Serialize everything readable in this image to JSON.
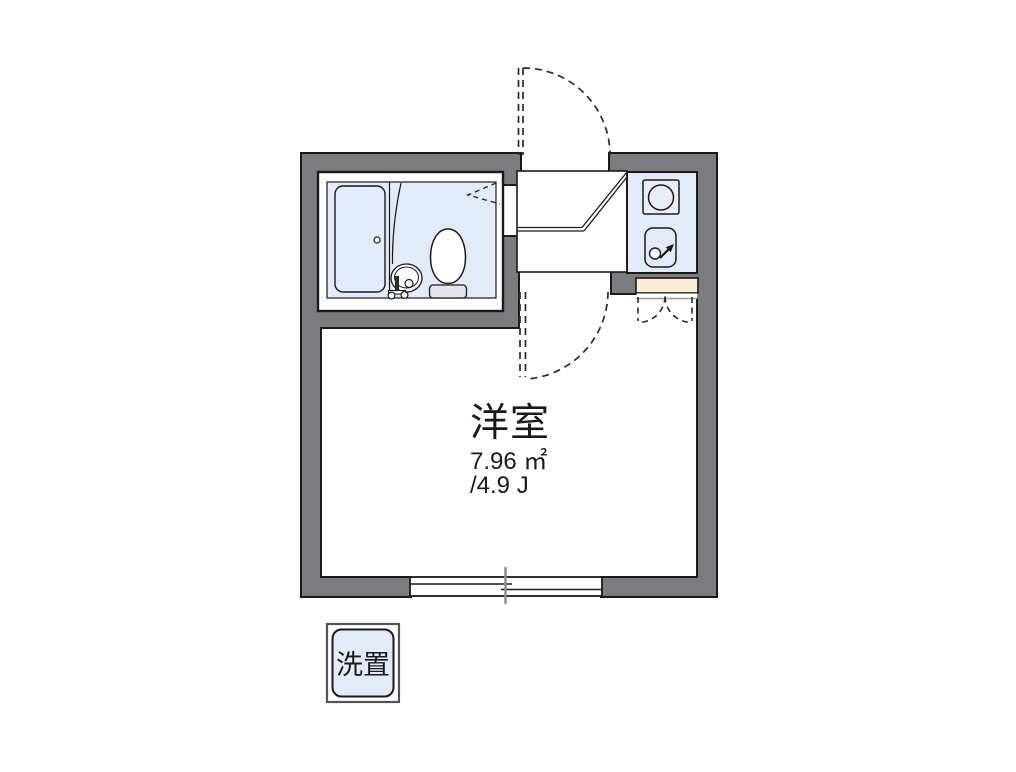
{
  "main_room": {
    "name": "洋室",
    "area_sqm": "7.96 ㎡",
    "tatami": "/4.9 J"
  },
  "laundry_box": {
    "label": "洗置"
  },
  "colors": {
    "wall_gray": "#7c7c80",
    "outline_black": "#1a1a1a",
    "wet_area_blue": "#e3eafa",
    "shoe_cabinet_cream": "#f8eed6",
    "background": "#ffffff"
  }
}
